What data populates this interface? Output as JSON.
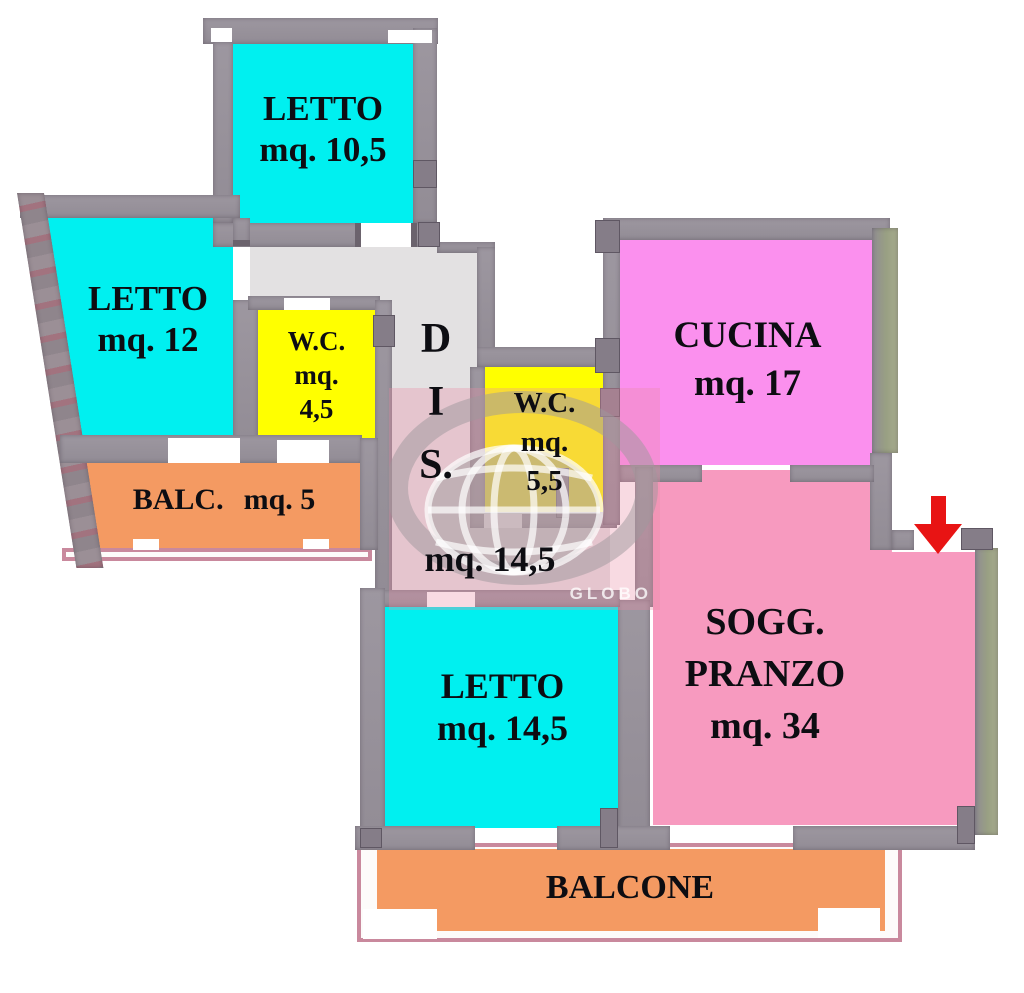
{
  "plan": {
    "type": "apartment-floor-plan",
    "watermark": {
      "text": "GLOBO"
    },
    "rooms": {
      "letto_top": {
        "name": "LETTO",
        "area": "mq. 10,5",
        "color": "#00f0f0"
      },
      "letto_left": {
        "name": "LETTO",
        "area": "mq. 12",
        "color": "#00f0f0"
      },
      "wc_small": {
        "name": "W.C.",
        "line2": "mq.",
        "line3": "4,5",
        "color": "#ffff00"
      },
      "balc_left": {
        "name": "BALC.",
        "area": "mq. 5",
        "color": "#f49a62"
      },
      "disimpegno": {
        "l1": "D",
        "l2": "I",
        "l3": "S.",
        "area": "mq. 14,5",
        "color": "#e3e1e2"
      },
      "wc_large": {
        "name": "W.C.",
        "line2": "mq.",
        "line3": "5,5",
        "color": "#ffff00"
      },
      "cucina": {
        "name": "CUCINA",
        "area": "mq. 17",
        "color": "#fb90ee"
      },
      "soggiorno": {
        "name1": "SOGG.",
        "name2": "PRANZO",
        "area": "mq. 34",
        "color": "#f79abf"
      },
      "letto_bottom": {
        "name": "LETTO",
        "area": "mq. 14,5",
        "color": "#00f0f0"
      },
      "balcone": {
        "name": "BALCONE",
        "color": "#f49a62"
      }
    },
    "colors": {
      "wall": "#98939b",
      "wall_outer_right": "#a2a98c",
      "corridor": "#e3e1e2",
      "entrance_arrow": "#e81414",
      "watermark_overlay": "rgba(233,140,164,0.32)",
      "balcony_rail": "#c9899d"
    }
  }
}
